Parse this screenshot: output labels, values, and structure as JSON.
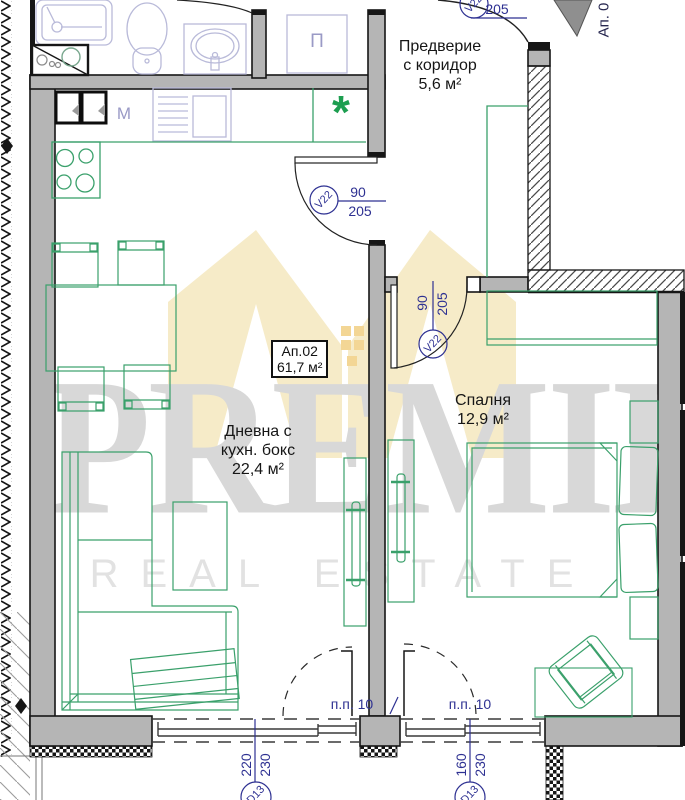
{
  "watermark": {
    "brand": "PREMIER",
    "tagline": "REAL ESTATE"
  },
  "apartment_box": {
    "number": "Ап.02",
    "area": "61,7 м²"
  },
  "rooms": {
    "vestibule": {
      "line1": "Предверие",
      "line2": "с коридор",
      "area": "5,6 м²"
    },
    "living": {
      "line1": "Дневна с",
      "line2": "кухн. бокс",
      "area": "22,4 м²"
    },
    "bedroom": {
      "line1": "Спалня",
      "area": "12,9 м²"
    }
  },
  "neighbor_label": "Ап. 0",
  "doors": {
    "entrance": {
      "tag": "V22",
      "height": "205"
    },
    "living": {
      "tag": "V22",
      "width": "90",
      "height": "205"
    },
    "bedroom": {
      "tag": "V22",
      "width": "90",
      "height": "205"
    }
  },
  "windows": {
    "living": {
      "tag": "D13",
      "width": "220",
      "height": "230",
      "parapet": "п.п. 10"
    },
    "bedroom": {
      "tag": "D13",
      "width": "160",
      "height": "230",
      "parapet": "п.п. 10"
    }
  },
  "appliances": {
    "washer": "M",
    "closet": "П",
    "fridge": "*"
  },
  "colors": {
    "wall": "#b5b5b5",
    "furniture": "#3aa06b",
    "fixtures": "#b9bad9",
    "dimension": "#2e3192",
    "watermark_logo": "#f6ebc8",
    "watermark_text": "#d8d8d8"
  }
}
